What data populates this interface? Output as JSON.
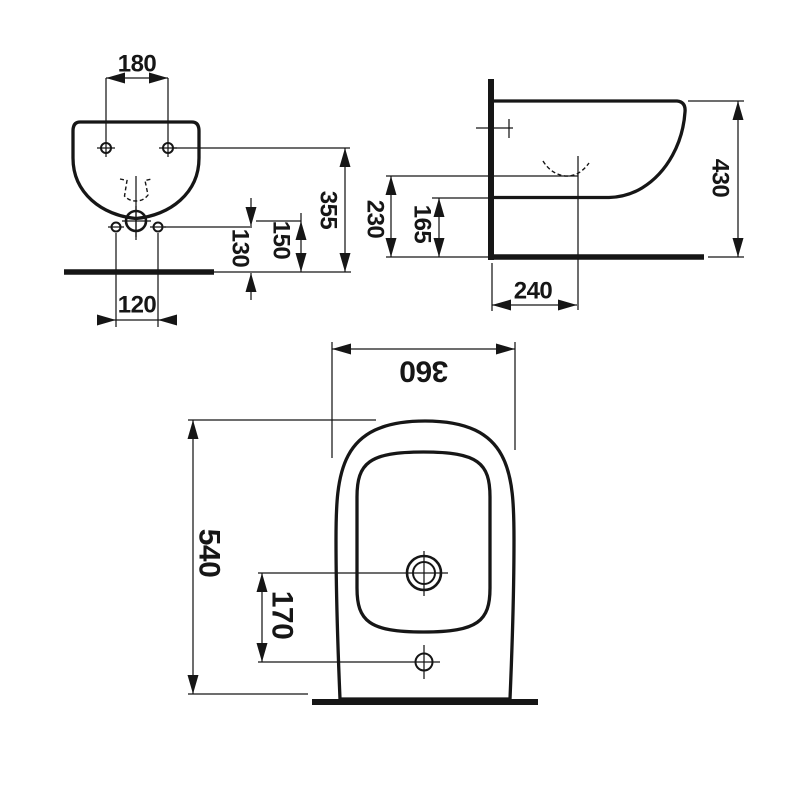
{
  "colors": {
    "ink": "#161616",
    "background": "#ffffff"
  },
  "views": {
    "front": {
      "dims": {
        "top_hole_spacing": "180",
        "top_holes_height": "355",
        "drain_height": "150",
        "lower_holes_height": "130",
        "lower_hole_spacing": "120"
      }
    },
    "side": {
      "dims": {
        "trap_height": "230",
        "underside_height": "165",
        "overall_height": "430",
        "trap_setout_from_wall": "240"
      }
    },
    "plan": {
      "dims": {
        "overall_width": "360",
        "overall_depth": "540",
        "drain_to_taphole": "170"
      }
    }
  }
}
